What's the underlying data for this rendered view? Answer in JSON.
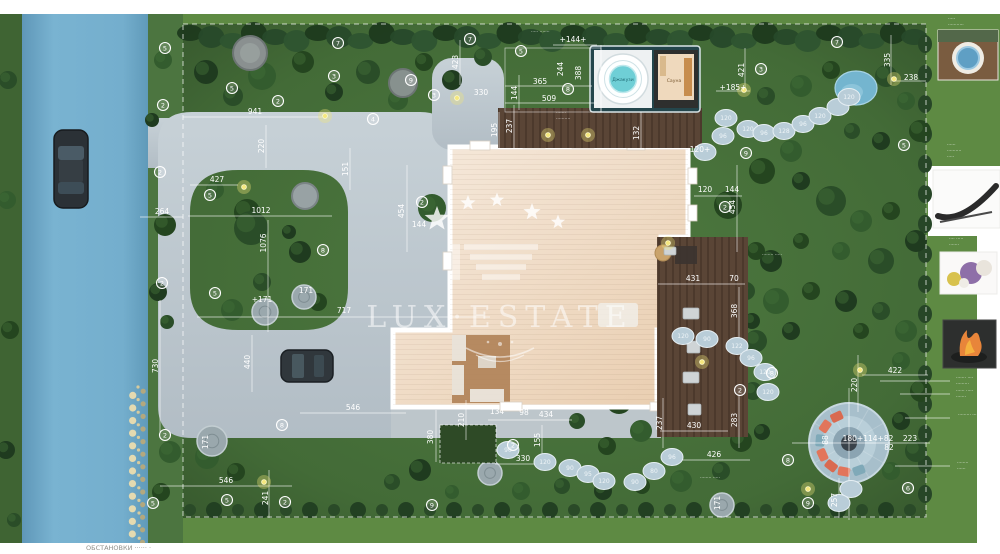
{
  "plan": {
    "watermark_text": "LUX·ESTATE",
    "jacuzzi_label": "Джакузи",
    "sauna_label": "Сауна",
    "corner_note": "ОБСТАНОВКИ ······ ·",
    "palette": {
      "grass_outer": "#5e8a43",
      "grass_site": "#47703a",
      "road_blue": "#74aecd",
      "paving_gray": "#bcc6cd",
      "roof_cream": "#f2e2d1",
      "deck_wood": "#5a4536",
      "teal_frame": "#24464c",
      "tub_water": "#6fcfd6",
      "firepit_stone": "#a7bfcb",
      "cushion_orange": "#e2755b",
      "annotation_white": "#ffffff"
    },
    "measurements": [
      {
        "t": "+144+",
        "x": 573,
        "y": 42
      },
      {
        "t": "365",
        "x": 540,
        "y": 84
      },
      {
        "t": "509",
        "x": 549,
        "y": 101
      },
      {
        "t": "144",
        "x": 517,
        "y": 93,
        "v": 1
      },
      {
        "t": "244",
        "x": 563,
        "y": 69,
        "v": 1
      },
      {
        "t": "388",
        "x": 581,
        "y": 73,
        "v": 1
      },
      {
        "t": "423",
        "x": 458,
        "y": 62,
        "v": 1
      },
      {
        "t": "330",
        "x": 481,
        "y": 95
      },
      {
        "t": "941",
        "x": 255,
        "y": 114
      },
      {
        "t": "220",
        "x": 264,
        "y": 146,
        "v": 1
      },
      {
        "t": "151",
        "x": 348,
        "y": 169,
        "v": 1
      },
      {
        "t": "237",
        "x": 512,
        "y": 126,
        "v": 1
      },
      {
        "t": "195",
        "x": 497,
        "y": 130,
        "v": 1
      },
      {
        "t": "132",
        "x": 639,
        "y": 133,
        "v": 1
      },
      {
        "t": "421",
        "x": 744,
        "y": 70,
        "v": 1
      },
      {
        "t": "335",
        "x": 890,
        "y": 60,
        "v": 1
      },
      {
        "t": "238",
        "x": 911,
        "y": 80
      },
      {
        "t": "+185+",
        "x": 733,
        "y": 90
      },
      {
        "t": "120+",
        "x": 700,
        "y": 152
      },
      {
        "t": "120",
        "x": 705,
        "y": 192
      },
      {
        "t": "144",
        "x": 732,
        "y": 192
      },
      {
        "t": "427",
        "x": 217,
        "y": 182
      },
      {
        "t": "264",
        "x": 162,
        "y": 214
      },
      {
        "t": "1012",
        "x": 261,
        "y": 213
      },
      {
        "t": "1076",
        "x": 266,
        "y": 243,
        "v": 1
      },
      {
        "t": "454",
        "x": 404,
        "y": 211,
        "v": 1
      },
      {
        "t": "144",
        "x": 419,
        "y": 227
      },
      {
        "t": "454",
        "x": 735,
        "y": 207,
        "v": 1
      },
      {
        "t": "+171",
        "x": 262,
        "y": 302
      },
      {
        "t": "171",
        "x": 306,
        "y": 293
      },
      {
        "t": "717",
        "x": 344,
        "y": 313
      },
      {
        "t": "431",
        "x": 693,
        "y": 281
      },
      {
        "t": "70",
        "x": 734,
        "y": 281
      },
      {
        "t": "368",
        "x": 737,
        "y": 311,
        "v": 1
      },
      {
        "t": "730",
        "x": 158,
        "y": 366,
        "v": 1
      },
      {
        "t": "440",
        "x": 250,
        "y": 362,
        "v": 1
      },
      {
        "t": "210",
        "x": 464,
        "y": 420,
        "v": 1
      },
      {
        "t": "380",
        "x": 433,
        "y": 437,
        "v": 1
      },
      {
        "t": "134",
        "x": 497,
        "y": 414
      },
      {
        "t": "98",
        "x": 524,
        "y": 415
      },
      {
        "t": "434",
        "x": 546,
        "y": 417
      },
      {
        "t": "155",
        "x": 540,
        "y": 440,
        "v": 1
      },
      {
        "t": "330",
        "x": 523,
        "y": 461
      },
      {
        "t": "283",
        "x": 737,
        "y": 420,
        "v": 1
      },
      {
        "t": "237",
        "x": 662,
        "y": 423,
        "v": 1
      },
      {
        "t": "430",
        "x": 694,
        "y": 428
      },
      {
        "t": "426",
        "x": 714,
        "y": 457
      },
      {
        "t": "546",
        "x": 353,
        "y": 410
      },
      {
        "t": "546",
        "x": 226,
        "y": 483
      },
      {
        "t": "241",
        "x": 268,
        "y": 498,
        "v": 1
      },
      {
        "t": "171",
        "x": 208,
        "y": 442,
        "v": 1
      },
      {
        "t": "422",
        "x": 895,
        "y": 373
      },
      {
        "t": "220",
        "x": 857,
        "y": 385,
        "v": 1
      },
      {
        "t": "180+114+82",
        "x": 868,
        "y": 441
      },
      {
        "t": "223",
        "x": 910,
        "y": 441
      },
      {
        "t": "82",
        "x": 889,
        "y": 450
      },
      {
        "t": "88",
        "x": 828,
        "y": 440,
        "v": 1
      },
      {
        "t": "257",
        "x": 837,
        "y": 500,
        "v": 1
      },
      {
        "t": "171",
        "x": 720,
        "y": 503,
        "v": 1
      }
    ],
    "plant_markers": [
      {
        "n": "5",
        "x": 165,
        "y": 48
      },
      {
        "n": "2",
        "x": 163,
        "y": 105
      },
      {
        "n": "5",
        "x": 232,
        "y": 88
      },
      {
        "n": "2",
        "x": 278,
        "y": 101
      },
      {
        "n": "3",
        "x": 334,
        "y": 76
      },
      {
        "n": "7",
        "x": 338,
        "y": 43
      },
      {
        "n": "4",
        "x": 373,
        "y": 119
      },
      {
        "n": "9",
        "x": 411,
        "y": 80
      },
      {
        "n": "3",
        "x": 434,
        "y": 95
      },
      {
        "n": "7",
        "x": 470,
        "y": 39
      },
      {
        "n": "5",
        "x": 521,
        "y": 51
      },
      {
        "n": "8",
        "x": 568,
        "y": 89
      },
      {
        "n": "3",
        "x": 761,
        "y": 69
      },
      {
        "n": "7",
        "x": 837,
        "y": 42
      },
      {
        "n": "9",
        "x": 746,
        "y": 153
      },
      {
        "n": "5",
        "x": 904,
        "y": 145
      },
      {
        "n": "2",
        "x": 160,
        "y": 172
      },
      {
        "n": "5",
        "x": 210,
        "y": 195
      },
      {
        "n": "2",
        "x": 162,
        "y": 283
      },
      {
        "n": "5",
        "x": 215,
        "y": 293
      },
      {
        "n": "8",
        "x": 323,
        "y": 250
      },
      {
        "n": "2",
        "x": 422,
        "y": 202
      },
      {
        "n": "2",
        "x": 725,
        "y": 207
      },
      {
        "n": "2",
        "x": 513,
        "y": 445
      },
      {
        "n": "9",
        "x": 432,
        "y": 505
      },
      {
        "n": "2",
        "x": 165,
        "y": 435
      },
      {
        "n": "5",
        "x": 153,
        "y": 503
      },
      {
        "n": "5",
        "x": 227,
        "y": 500
      },
      {
        "n": "8",
        "x": 282,
        "y": 425
      },
      {
        "n": "2",
        "x": 285,
        "y": 502
      },
      {
        "n": "8",
        "x": 772,
        "y": 373
      },
      {
        "n": "2",
        "x": 740,
        "y": 390
      },
      {
        "n": "8",
        "x": 788,
        "y": 460
      },
      {
        "n": "6",
        "x": 908,
        "y": 488
      },
      {
        "n": "9",
        "x": 808,
        "y": 503
      }
    ],
    "stepping_stones": {
      "top_path": [
        {
          "x": 705,
          "y": 152,
          "n": ""
        },
        {
          "x": 723,
          "y": 136,
          "n": "96"
        },
        {
          "x": 726,
          "y": 118,
          "n": "120"
        },
        {
          "x": 748,
          "y": 129,
          "n": "120"
        },
        {
          "x": 764,
          "y": 133,
          "n": "96"
        },
        {
          "x": 784,
          "y": 131,
          "n": "128"
        },
        {
          "x": 803,
          "y": 124,
          "n": "96"
        },
        {
          "x": 820,
          "y": 116,
          "n": "120"
        },
        {
          "x": 838,
          "y": 107,
          "n": ""
        },
        {
          "x": 849,
          "y": 97,
          "n": "120"
        }
      ],
      "deck_path": [
        {
          "x": 683,
          "y": 336,
          "n": "120"
        },
        {
          "x": 707,
          "y": 339,
          "n": "90"
        },
        {
          "x": 737,
          "y": 346,
          "n": "122"
        },
        {
          "x": 751,
          "y": 358,
          "n": "96"
        },
        {
          "x": 765,
          "y": 372,
          "n": "120"
        },
        {
          "x": 768,
          "y": 392,
          "n": "120"
        }
      ],
      "bottom_path": [
        {
          "x": 508,
          "y": 450,
          "n": "90"
        },
        {
          "x": 545,
          "y": 462,
          "n": "120"
        },
        {
          "x": 570,
          "y": 468,
          "n": "90"
        },
        {
          "x": 588,
          "y": 474,
          "n": "95"
        },
        {
          "x": 604,
          "y": 481,
          "n": "120"
        },
        {
          "x": 635,
          "y": 482,
          "n": "90"
        },
        {
          "x": 654,
          "y": 471,
          "n": "80"
        },
        {
          "x": 672,
          "y": 457,
          "n": "96"
        },
        {
          "x": 851,
          "y": 489,
          "n": ""
        },
        {
          "x": 839,
          "y": 503,
          "n": ""
        }
      ]
    },
    "micro_labels": [
      {
        "t": "····· ·······",
        "x": 531,
        "y": 33
      },
      {
        "t": "·······",
        "x": 556,
        "y": 114
      },
      {
        "t": "··········",
        "x": 556,
        "y": 120
      },
      {
        "t": "········ ·····",
        "x": 762,
        "y": 256
      },
      {
        "t": "········ ·····",
        "x": 700,
        "y": 479
      },
      {
        "t": "·····",
        "x": 948,
        "y": 20
      },
      {
        "t": "···········",
        "x": 948,
        "y": 26
      },
      {
        "t": "······",
        "x": 948,
        "y": 32
      },
      {
        "t": "······",
        "x": 947,
        "y": 146
      },
      {
        "t": "··········",
        "x": 947,
        "y": 152
      },
      {
        "t": "·····",
        "x": 947,
        "y": 158
      },
      {
        "t": "···· ·····",
        "x": 949,
        "y": 240
      },
      {
        "t": "·······",
        "x": 949,
        "y": 246
      },
      {
        "t": "······· ····",
        "x": 956,
        "y": 379
      },
      {
        "t": "·········",
        "x": 956,
        "y": 385
      },
      {
        "t": "······ ·····",
        "x": 956,
        "y": 392
      },
      {
        "t": "·······",
        "x": 956,
        "y": 398
      },
      {
        "t": "········· ····",
        "x": 958,
        "y": 416
      },
      {
        "t": "········",
        "x": 957,
        "y": 464
      },
      {
        "t": "······",
        "x": 957,
        "y": 470
      }
    ]
  }
}
